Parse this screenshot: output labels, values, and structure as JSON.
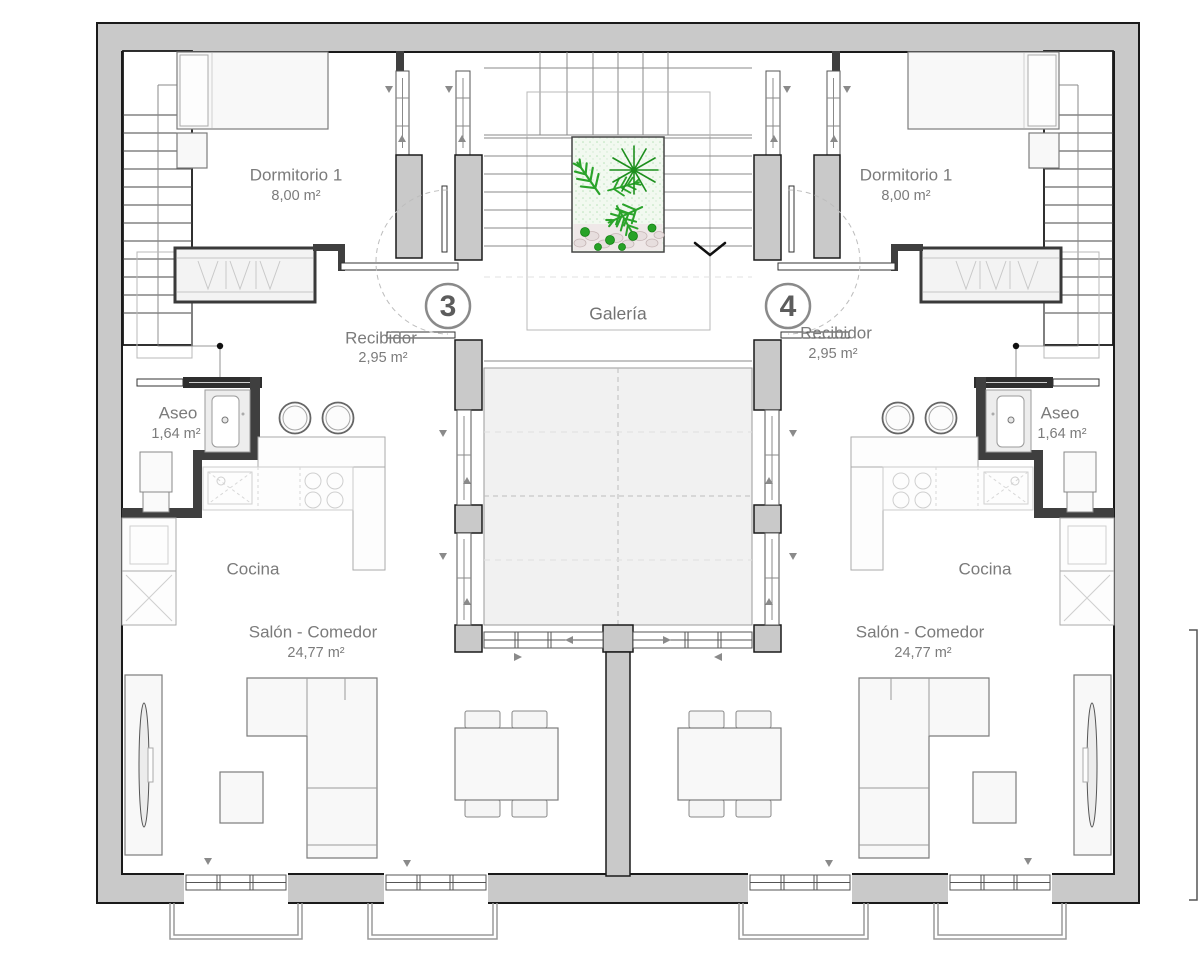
{
  "plan": {
    "gallery_label": "Galería",
    "apartments": [
      {
        "unit": "3",
        "bedroom_name": "Dormitorio 1",
        "bedroom_area": "8,00 m²",
        "hall_name": "Recibidor",
        "hall_area": "2,95 m²",
        "bath_name": "Aseo",
        "bath_area": "1,64 m²",
        "kitchen_name": "Cocina",
        "living_name": "Salón - Comedor",
        "living_area": "24,77 m²"
      },
      {
        "unit": "4",
        "bedroom_name": "Dormitorio 1",
        "bedroom_area": "8,00 m²",
        "hall_name": "Recibidor",
        "hall_area": "2,95 m²",
        "bath_name": "Aseo",
        "bath_area": "1,64 m²",
        "kitchen_name": "Cocina",
        "living_name": "Salón - Comedor",
        "living_area": "24,77 m²"
      }
    ]
  },
  "colors": {
    "wall_fill": "#c9c9c9",
    "wall_outline": "#1a1a1a",
    "partition": "#3f3f3f",
    "courtyard_floor": "#f1f1f1",
    "label_text": "#7b7b7b",
    "plant_green": "#2aa32a",
    "plant_dark_green": "#1d8f1d",
    "pebble": "#e7dede"
  },
  "symbols": {
    "stair_direction_arrow": "chevron-right",
    "gallery_down_arrow": "chevron-down",
    "window_slide_arrow": "small-triangle"
  }
}
